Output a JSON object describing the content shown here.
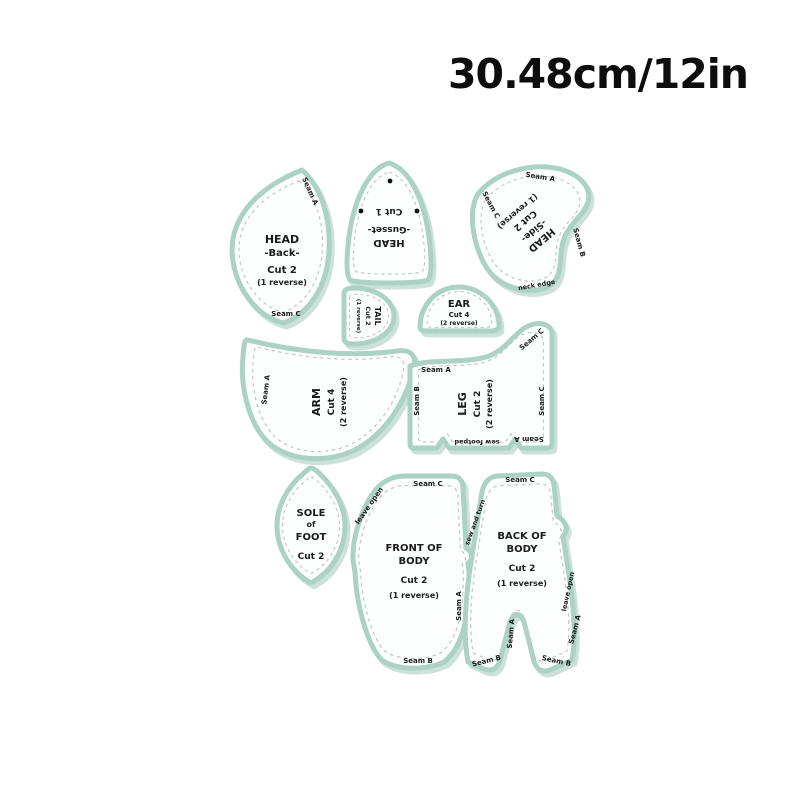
{
  "header": {
    "size_label": "30.48cm/12in"
  },
  "colors": {
    "outline_mint": "#abd2c4",
    "fill_white": "#fdfffe",
    "stitch_gray": "#c2c8c8",
    "text_black": "#1b1b1b"
  },
  "pieces": {
    "head_back": {
      "lines": [
        "HEAD",
        "-Back-",
        "Cut 2",
        "(1 reverse)"
      ],
      "seam_top": "Seam A",
      "seam_bottom": "Seam C"
    },
    "head_gusset": {
      "lines": [
        "HEAD",
        "-Gusset-",
        "Cut 1"
      ]
    },
    "head_side": {
      "lines": [
        "HEAD",
        "-Side-",
        "Cut 2",
        "(1 reverse)"
      ],
      "seam_top": "Seam A",
      "seam_left": "Seam C",
      "seam_right": "Seam B",
      "note_bottom": "neck edge"
    },
    "tail": {
      "lines": [
        "TAIL",
        "Cut 2",
        "(1 reverse)"
      ]
    },
    "ear": {
      "lines": [
        "EAR",
        "Cut 4",
        "(2 reverse)"
      ]
    },
    "arm": {
      "lines": [
        "ARM",
        "Cut 4",
        "(2 reverse)"
      ],
      "seam_left": "Seam A"
    },
    "leg": {
      "lines": [
        "LEG",
        "Cut 2",
        "(2 reverse)"
      ],
      "seam_top": "Seam A",
      "seam_left": "Seam B",
      "seam_right": "Seam C",
      "seam_diag": "Seam C",
      "seam_bottom": "Seam A",
      "note_bottom": "sew footpad"
    },
    "sole": {
      "lines": [
        "SOLE",
        "of",
        "FOOT",
        "Cut 2"
      ]
    },
    "front_body": {
      "lines": [
        "FRONT OF",
        "BODY",
        "Cut 2",
        "(1 reverse)"
      ],
      "seam_top": "Seam C",
      "seam_diag": "leave open",
      "seam_right": "Seam A",
      "seam_bottom": "Seam B"
    },
    "back_body": {
      "lines": [
        "BACK OF",
        "BODY",
        "Cut 2",
        "(1 reverse)"
      ],
      "seam_top": "Seam C",
      "seam_diag": "sew and turn",
      "note_right": "leave open",
      "seam_right": "Seam A",
      "seam_inner": "Seam A",
      "seam_bottom_left": "Seam B",
      "seam_bottom_right": "Seam B"
    }
  }
}
